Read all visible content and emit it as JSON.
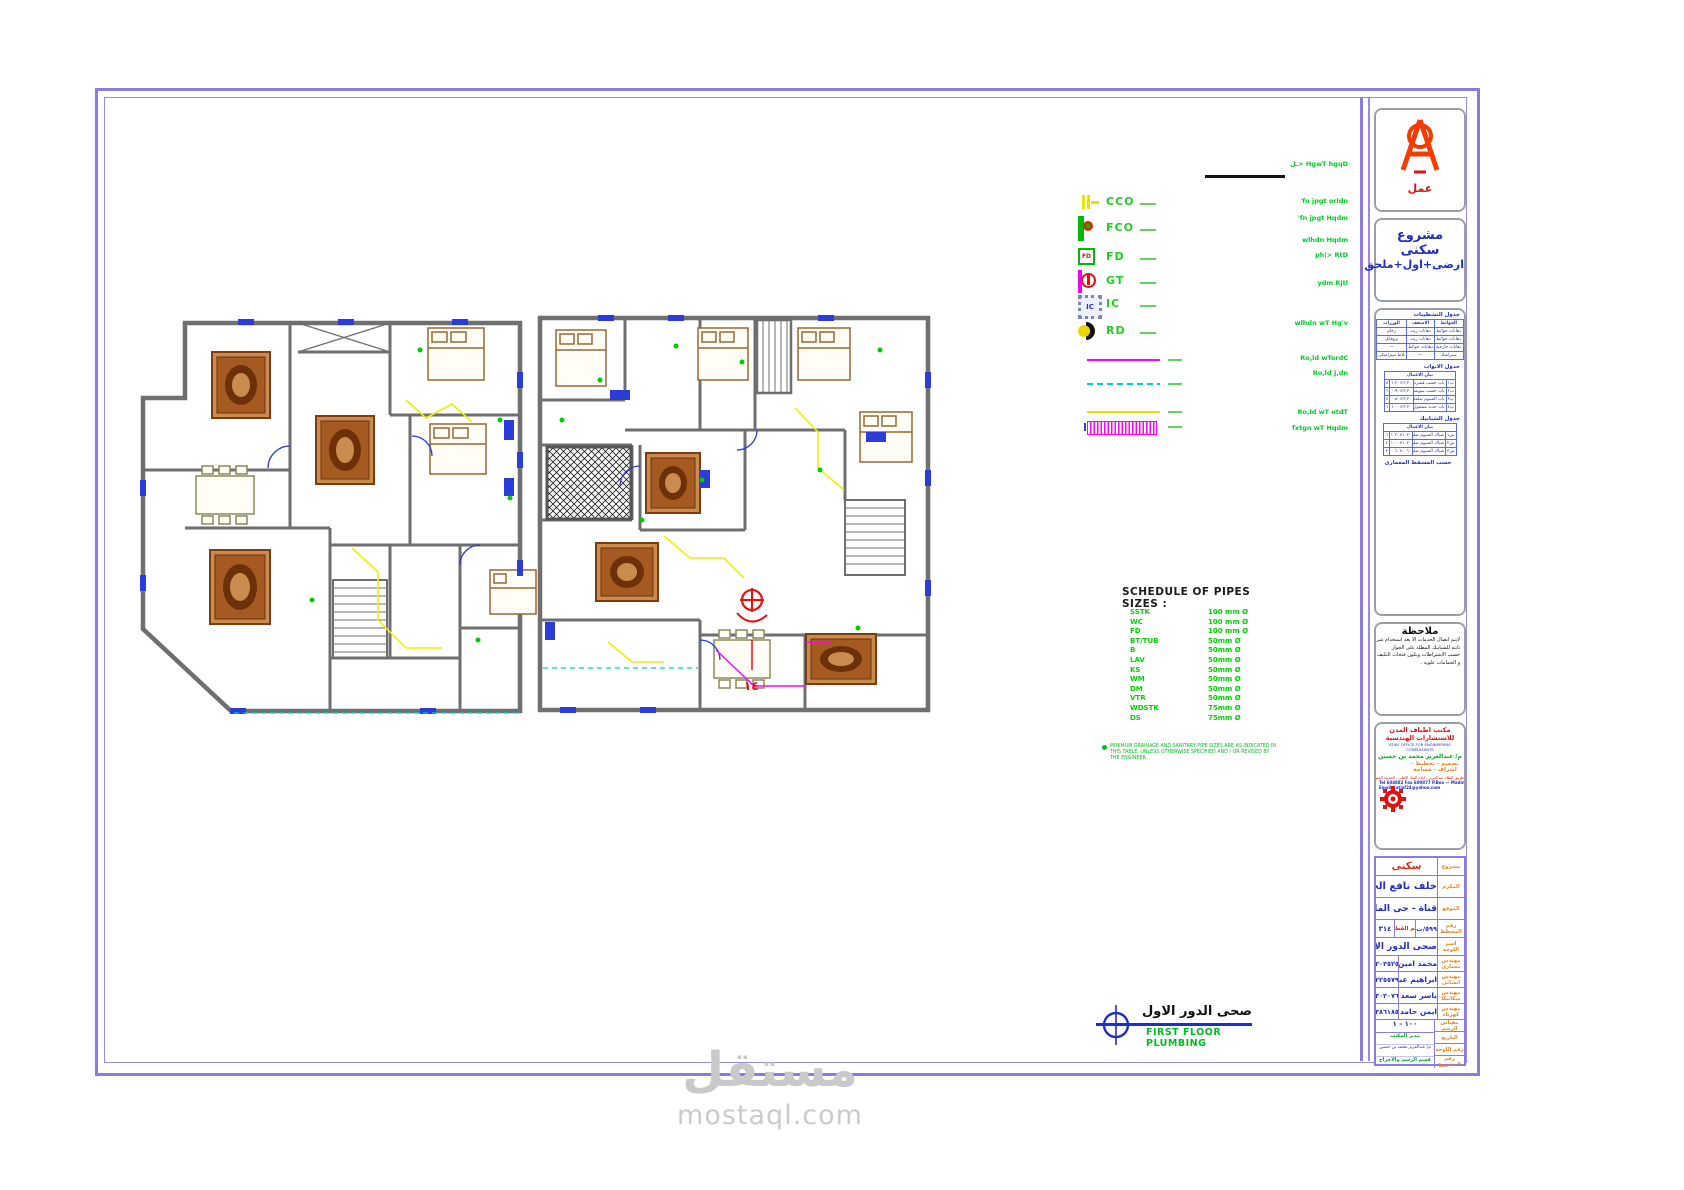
{
  "plan": {
    "title_ar": "صحى الدور الاول",
    "title_en": "FIRST FLOOR PLUMBING",
    "red_marker": "١٤"
  },
  "watermark": {
    "wordmark": "مستقل",
    "domain": "mostaql.com"
  },
  "legend": {
    "annotations": [
      "ـل> HgwT hgqD",
      "'fn jpgt orldn",
      "'fn jpgt Hqdm",
      "wlhdn Hqdm",
      "ph|> RtD",
      "ydm Rjtl",
      "wlhdn wT Hg'v",
      "Ro,ld wTordC",
      "Ro,ld J,dn",
      "Ro,ld wT otdT",
      "fxtgn wT Hqdm"
    ],
    "symbols": [
      {
        "id": "cco",
        "label": "CCO",
        "glyph": ""
      },
      {
        "id": "fco",
        "label": "FCO",
        "glyph": ""
      },
      {
        "id": "fd",
        "label": "FD",
        "glyph": "FD"
      },
      {
        "id": "gt",
        "label": "GT",
        "glyph": ""
      },
      {
        "id": "ic",
        "label": "IC",
        "glyph": "IC"
      },
      {
        "id": "rd",
        "label": "RD",
        "glyph": ""
      }
    ]
  },
  "pipe_schedule": {
    "title": "SCHEDULE OF PIPES SIZES :",
    "rows": [
      {
        "item": "SSTK",
        "size": "100 mm Ø"
      },
      {
        "item": "WC",
        "size": "100 mm Ø"
      },
      {
        "item": "FD",
        "size": "100 mm Ø"
      },
      {
        "item": "BT/TUB",
        "size": "50mm Ø"
      },
      {
        "item": "B",
        "size": "50mm Ø"
      },
      {
        "item": "LAV",
        "size": "50mm Ø"
      },
      {
        "item": "KS",
        "size": "50mm Ø"
      },
      {
        "item": "WM",
        "size": "50mm Ø"
      },
      {
        "item": "DM",
        "size": "50mm Ø"
      },
      {
        "item": "VTR",
        "size": "50mm Ø"
      },
      {
        "item": "WDSTK",
        "size": "75mm Ø"
      },
      {
        "item": "DS",
        "size": "75mm Ø"
      }
    ],
    "note": "MINIMUM DRAINAGE AND SANITARY PIPE SIZES ARE AS INDICATED IN THIS TABLE, UNLESS OTHERWISE SPECIFIED AND / OR REVISED BY THE ENGINEER."
  },
  "titleblock": {
    "logo_text": "عمل",
    "project_title_lines": [
      "مشروع",
      "سكنى",
      "ارضى+اول+ملحق"
    ],
    "finishes": {
      "title": "جدول التشطيبات",
      "headers": [
        "م",
        "الارضيات",
        "الحوائط",
        "الاسقف",
        "الوزرات"
      ],
      "rows": [
        [
          "١",
          "بلاط رخام",
          "دهانات حوائط",
          "دهانات زيت",
          "رخام"
        ],
        [
          "٢",
          "سيراميك",
          "دهانات حوائط",
          "دهانات زيت",
          "بروفايل"
        ],
        [
          "٣",
          "بلاط حجرى",
          "دهانات خارجية",
          "دهانات حوائط",
          "—"
        ],
        [
          "٤",
          "بلاط متداخل",
          "سيراميك",
          "—",
          "بلاط سيراميكى"
        ]
      ]
    },
    "doors": {
      "title": "جدول الابواب",
      "header": "بيان الاعمال",
      "rows": [
        [
          "ب١",
          "باب خشب قشرة ابيض الدهان زيت",
          "٢.٢٠×١.٢٠",
          "٨"
        ],
        [
          "ب٢",
          "باب خشب سويسكى قشرة زان الدهان",
          "٢.٢٠×٠.٩٠",
          "٦"
        ],
        [
          "ب٣",
          "باب المنيوم ضلفة مع زجاج",
          "٢.٢٠×٠.٨٠",
          "٤"
        ],
        [
          "ب٤",
          "باب حديد مشغول",
          "٢.٢٠×١.٠٠",
          "١"
        ]
      ]
    },
    "windows": {
      "title": "جدول الشبابيك",
      "header": "بيان الاعمال",
      "rows": [
        [
          "ش١",
          "شباك المنيوم ضلفتين منزلق",
          "١.٢٠×١.٢٠",
          "٦"
        ],
        [
          "ش٢",
          "شباك المنيوم ضلفتين منزلق",
          "١.٢٠×١.٠٠",
          "٤"
        ],
        [
          "ش٣",
          "شباك المنيوم ضلفة منزلق",
          "٠.٦٠×٠.٦٠",
          "٣"
        ]
      ],
      "footer": "حسب المسقط المعمارى"
    },
    "note": {
      "title": "ملاحظة",
      "lines": [
        "لايتم ايصال الخدمات الا بعد استخدام شرائح البلوميوم",
        "ثابتة للشبابيك المطلة على الجوار",
        "حسب الاشتراطات ويكون فتحات التكيف",
        "و الحمامات علوية ."
      ]
    },
    "office": {
      "name_ar": "مكتب اطياف المدن للاستشارات الهندسية",
      "name_en": "ATIAF OFFICE FOR ENGINEERING CONSULTANTS",
      "engineer": "م/ عبدالعزيز محمد بن حسين",
      "services": "تصميم - تخطيط - اشراف - مساحة",
      "address": "طريق الملك عبدالعزيز - امام البنك الاهلى - المدينة المنورة ١/٢٣٤",
      "tel": "Tel 604882  Fax 600877  P.Box — Madinah , KSA Licensed 1/234",
      "email": "Email : atiaf24@yahoo.com"
    },
    "info": {
      "project": {
        "label": "مشروع",
        "value": "سكنى"
      },
      "owner": {
        "label": "المكرم",
        "value": "خلف نافع الحربى"
      },
      "location": {
        "label": "الموقع",
        "value": "قناة  -  حى الملك فهد"
      },
      "plot": {
        "label": "رقم المخطط",
        "value": "٥٩٩/ت /١٤١٣",
        "sub_label": "رقم القطعة",
        "sub_value": "٣١٤"
      },
      "sheet_name": {
        "label": "اسم اللوحة",
        "value": "صحى الدور الاول"
      },
      "engineers": [
        {
          "label": "مهندس معمارى",
          "name": "محمد امين الوجيه",
          "license": "٢٠٣٥٢٥"
        },
        {
          "label": "مهندس انشائى",
          "name": "ابراهيم عبد العال",
          "license": "٢٢٥٥٧٩"
        },
        {
          "label": "مهندس ميكانيكا",
          "name": "ياسر سعد الجعفى",
          "license": "٣٠٢٠٧٦"
        },
        {
          "label": "مهندس كهرباء",
          "name": "ايمن حامد العوفى",
          "license": "٣٨٦١٨٥"
        }
      ],
      "scale": {
        "label": "مقياس الرسم",
        "value": "١٠٠ - ١"
      },
      "manager": {
        "label": "مدير المكتب",
        "value": "م/ عبدالعزيز محمد بن حسين"
      },
      "dept": {
        "label": "قسم الرسم والاخراج"
      },
      "date": {
        "label": "التاريخ",
        "value": ""
      },
      "sheet_no": {
        "label": "رقم اللوحة",
        "value": ""
      },
      "project_no": {
        "label": "رقم المشروع",
        "value": ""
      }
    }
  }
}
